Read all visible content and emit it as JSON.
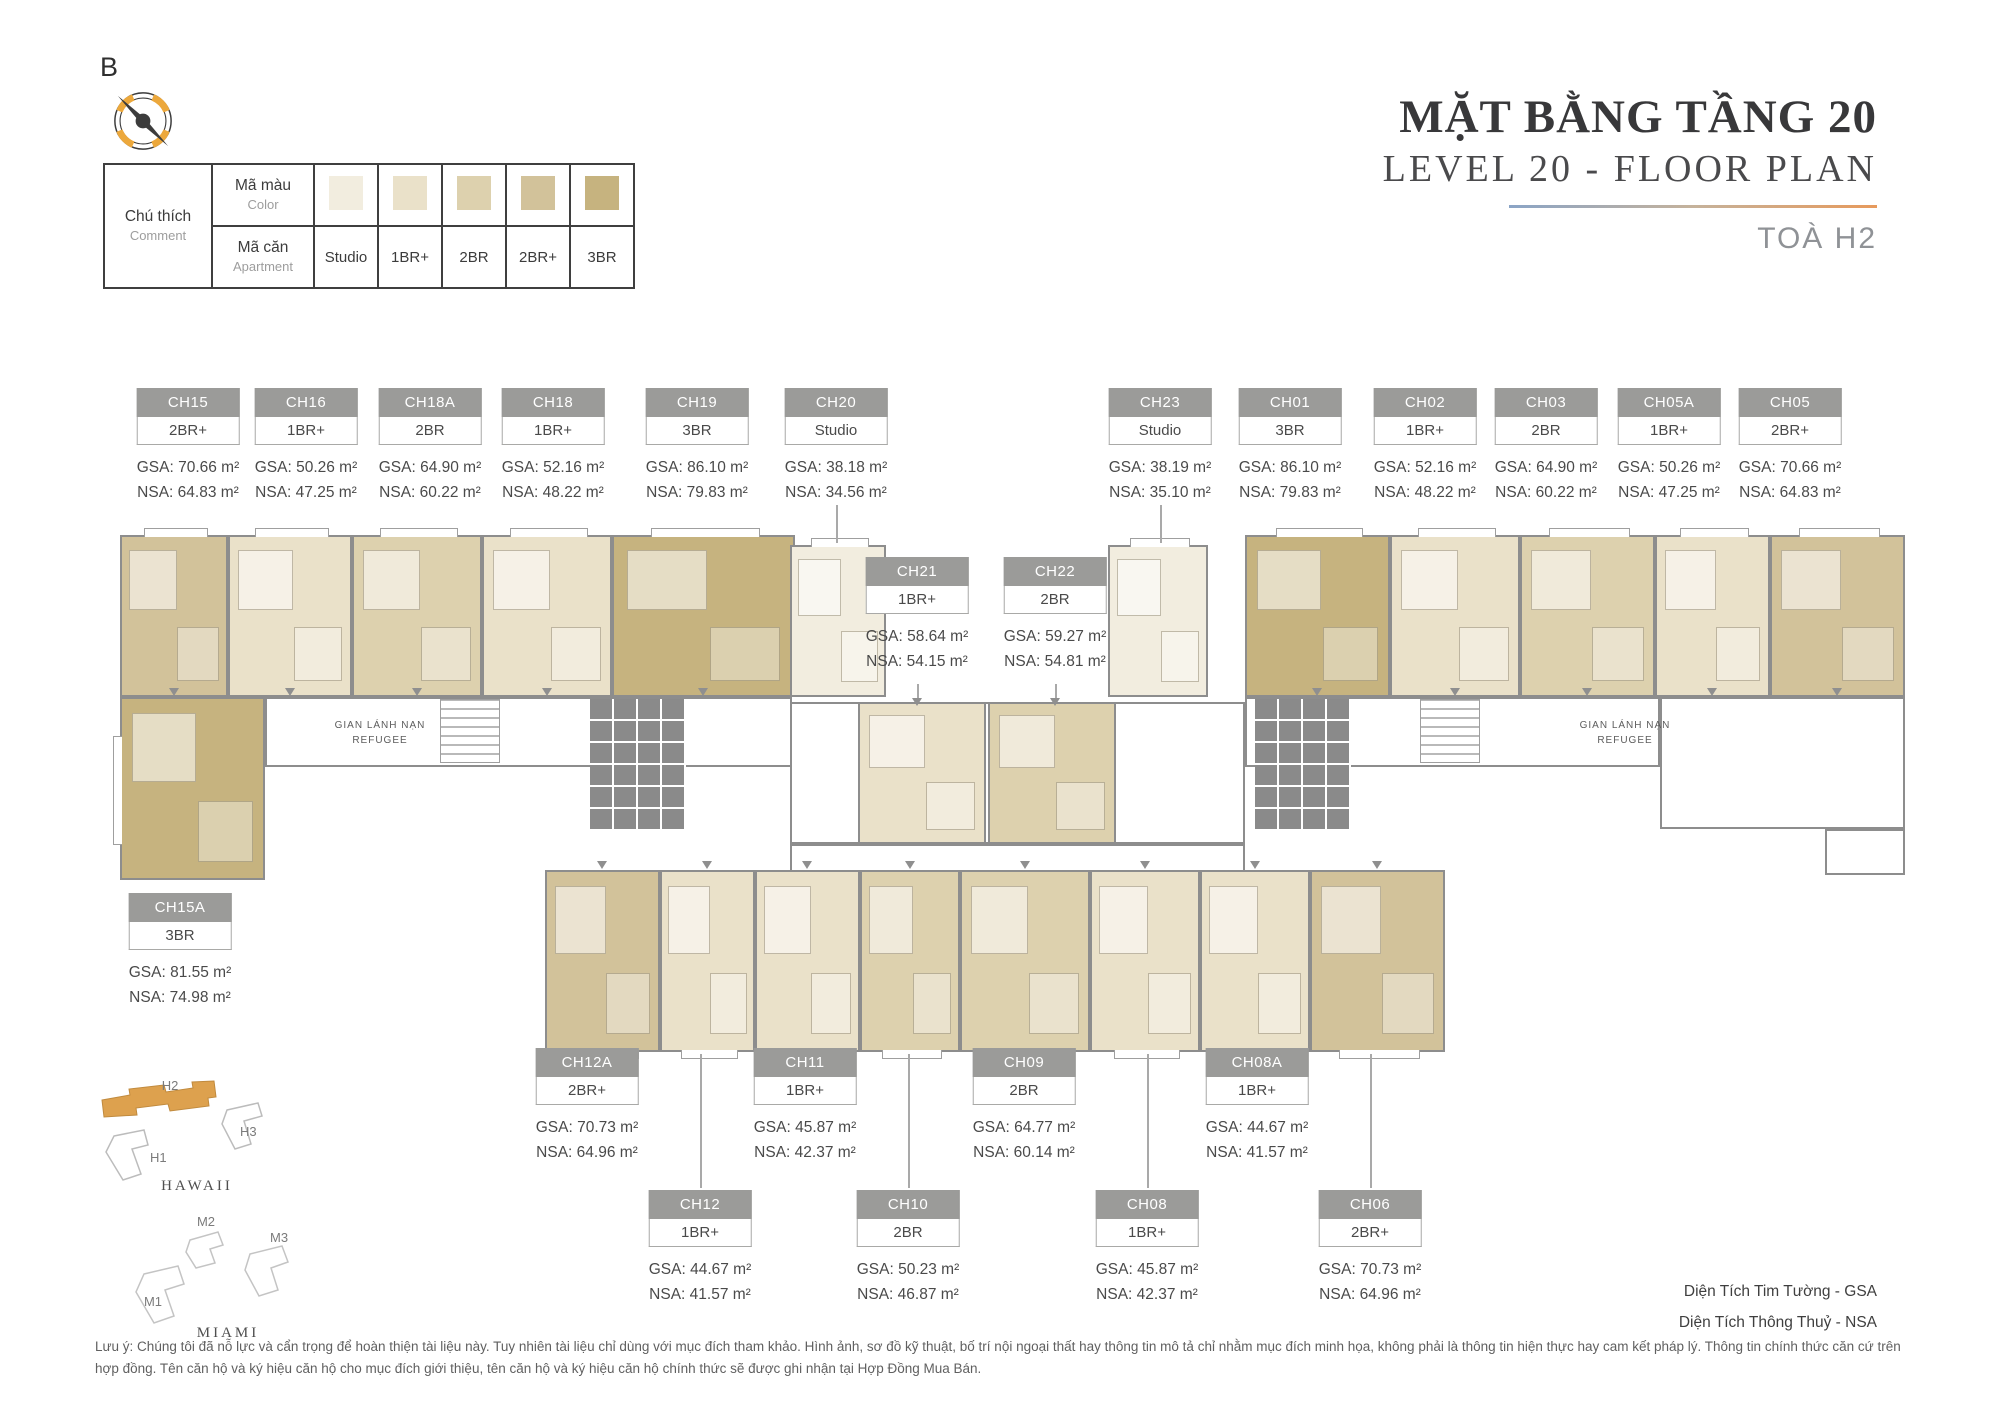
{
  "page": {
    "north_label": "B",
    "title_vi": "MẶT BẰNG TẦNG 20",
    "title_en": "LEVEL 20 - FLOOR PLAN",
    "building": "TOÀ H2"
  },
  "legend": {
    "comment_vi": "Chú thích",
    "comment_en": "Comment",
    "color_vi": "Mã màu",
    "color_en": "Color",
    "apartment_vi": "Mã căn",
    "apartment_en": "Apartment",
    "types": [
      {
        "label": "Studio",
        "color": "#F2EDDF"
      },
      {
        "label": "1BR+",
        "color": "#EAE1C9"
      },
      {
        "label": "2BR",
        "color": "#DDD1AE"
      },
      {
        "label": "2BR+",
        "color": "#D2C29A"
      },
      {
        "label": "3BR",
        "color": "#C6B37F"
      }
    ]
  },
  "plan": {
    "refugee_area_vi": "GIAN LÁNH NẠN",
    "refugee_area_en": "REFUGEE"
  },
  "units": [
    {
      "id": "CH15",
      "type": "2BR+",
      "gsa": "70.66",
      "nsa": "64.83"
    },
    {
      "id": "CH16",
      "type": "1BR+",
      "gsa": "50.26",
      "nsa": "47.25"
    },
    {
      "id": "CH18A",
      "type": "2BR",
      "gsa": "64.90",
      "nsa": "60.22"
    },
    {
      "id": "CH18",
      "type": "1BR+",
      "gsa": "52.16",
      "nsa": "48.22"
    },
    {
      "id": "CH19",
      "type": "3BR",
      "gsa": "86.10",
      "nsa": "79.83"
    },
    {
      "id": "CH20",
      "type": "Studio",
      "gsa": "38.18",
      "nsa": "34.56"
    },
    {
      "id": "CH21",
      "type": "1BR+",
      "gsa": "58.64",
      "nsa": "54.15"
    },
    {
      "id": "CH22",
      "type": "2BR",
      "gsa": "59.27",
      "nsa": "54.81"
    },
    {
      "id": "CH23",
      "type": "Studio",
      "gsa": "38.19",
      "nsa": "35.10"
    },
    {
      "id": "CH01",
      "type": "3BR",
      "gsa": "86.10",
      "nsa": "79.83"
    },
    {
      "id": "CH02",
      "type": "1BR+",
      "gsa": "52.16",
      "nsa": "48.22"
    },
    {
      "id": "CH03",
      "type": "2BR",
      "gsa": "64.90",
      "nsa": "60.22"
    },
    {
      "id": "CH05A",
      "type": "1BR+",
      "gsa": "50.26",
      "nsa": "47.25"
    },
    {
      "id": "CH05",
      "type": "2BR+",
      "gsa": "70.66",
      "nsa": "64.83"
    },
    {
      "id": "CH15A",
      "type": "3BR",
      "gsa": "81.55",
      "nsa": "74.98"
    },
    {
      "id": "CH12A",
      "type": "2BR+",
      "gsa": "70.73",
      "nsa": "64.96"
    },
    {
      "id": "CH11",
      "type": "1BR+",
      "gsa": "45.87",
      "nsa": "42.37"
    },
    {
      "id": "CH09",
      "type": "2BR",
      "gsa": "64.77",
      "nsa": "60.14"
    },
    {
      "id": "CH08A",
      "type": "1BR+",
      "gsa": "44.67",
      "nsa": "41.57"
    },
    {
      "id": "CH12",
      "type": "1BR+",
      "gsa": "44.67",
      "nsa": "41.57"
    },
    {
      "id": "CH10",
      "type": "2BR",
      "gsa": "50.23",
      "nsa": "46.87"
    },
    {
      "id": "CH08",
      "type": "1BR+",
      "gsa": "45.87",
      "nsa": "42.37"
    },
    {
      "id": "CH06",
      "type": "2BR+",
      "gsa": "70.73",
      "nsa": "64.96"
    }
  ],
  "unit_text": {
    "gsa_prefix": "GSA: ",
    "nsa_prefix": "NSA: ",
    "area_suffix": " m²"
  },
  "minimap": {
    "hawaii": {
      "name": "HAWAII",
      "buildings": [
        "H1",
        "H2",
        "H3"
      ],
      "highlighted": "H2",
      "highlight_color": "#DDA14E"
    },
    "miami": {
      "name": "MIAMI",
      "buildings": [
        "M1",
        "M2",
        "M3"
      ]
    }
  },
  "area_notes": [
    "Diện Tích Tim Tường - GSA",
    "Diện Tích Thông Thuỷ - NSA"
  ],
  "disclaimer": "Lưu ý: Chúng tôi đã nỗ lực và cẩn trọng để hoàn thiện tài liệu này. Tuy nhiên tài liệu chỉ dùng với mục đích tham khảo. Hình ảnh, sơ đồ kỹ thuật, bố trí nội ngoại thất hay thông tin mô tả chỉ nhằm mục đích minh họa, không phải là thông tin hiện thực hay cam kết pháp lý. Thông tin chính thức căn cứ trên hợp đồng. Tên căn hộ và ký hiệu căn hộ cho mục đích giới thiệu, tên căn hộ và ký hiệu căn hộ chính thức sẽ được ghi nhận tại Hợp Đồng Mua Bán."
}
